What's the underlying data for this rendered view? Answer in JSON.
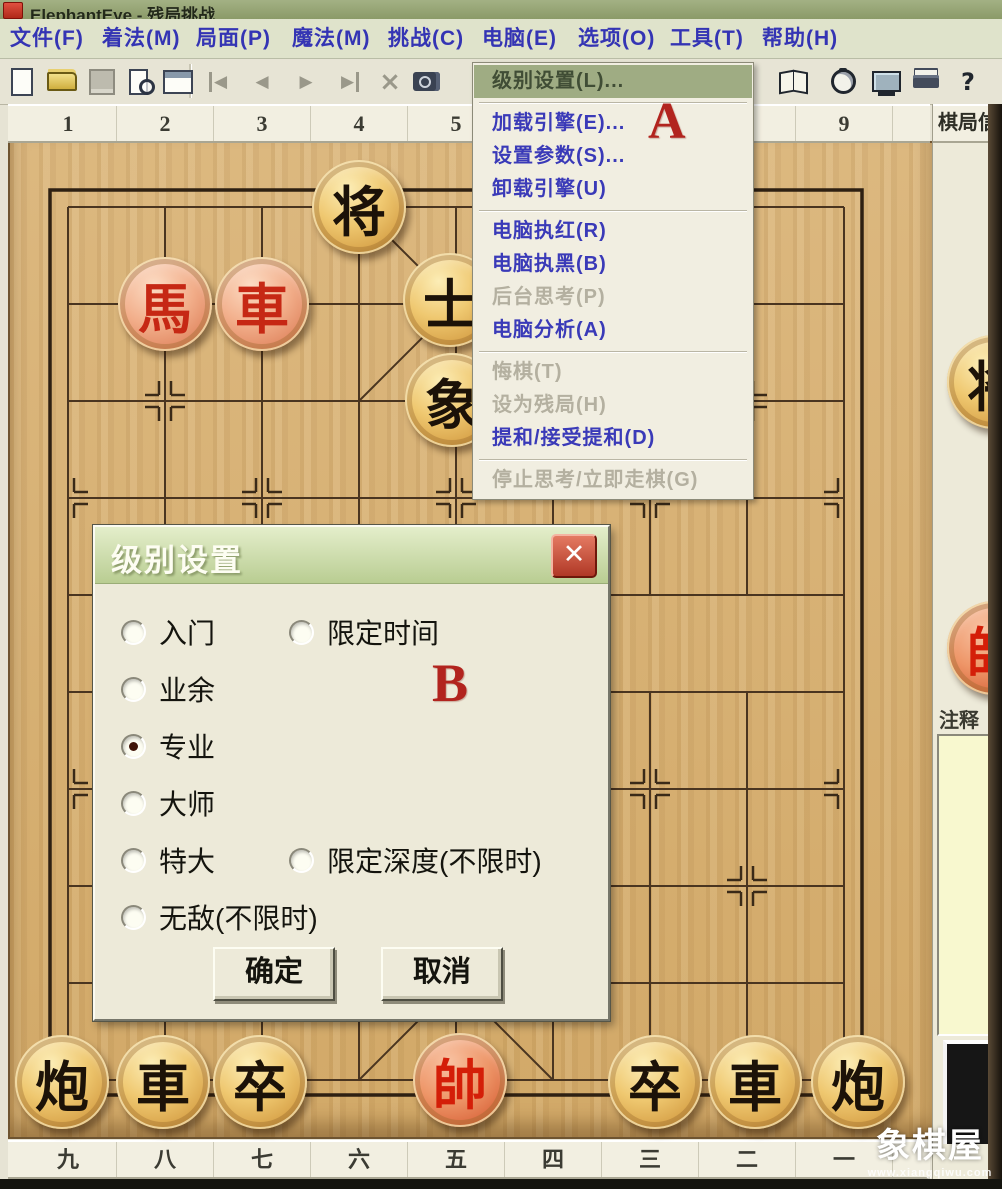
{
  "window": {
    "title": "ElephantEye - 残局挑战"
  },
  "menu_bar": {
    "items": [
      {
        "label": "文件(F)"
      },
      {
        "label": "着法(M)"
      },
      {
        "label": "局面(P)"
      },
      {
        "label": "魔法(M)"
      },
      {
        "label": "挑战(C)"
      },
      {
        "label": "电脑(E)",
        "open": true
      },
      {
        "label": "选项(O)"
      },
      {
        "label": "工具(T)"
      },
      {
        "label": "帮助(H)"
      }
    ]
  },
  "toolbar": {
    "icons": [
      {
        "name": "new-document-icon"
      },
      {
        "name": "open-file-icon"
      },
      {
        "name": "save-icon"
      },
      {
        "name": "print-preview-icon"
      },
      {
        "name": "board-properties-icon"
      },
      {
        "name": "first-move-icon",
        "glyph": "◀"
      },
      {
        "name": "previous-move-icon",
        "glyph": "◀"
      },
      {
        "name": "next-move-icon",
        "glyph": "▶"
      },
      {
        "name": "last-move-icon",
        "glyph": "▶"
      },
      {
        "name": "delete-move-icon",
        "glyph": "×"
      },
      {
        "name": "snapshot-icon"
      },
      {
        "name": "opening-book-icon"
      },
      {
        "name": "timer-icon"
      },
      {
        "name": "engine-icon"
      },
      {
        "name": "print-icon"
      },
      {
        "name": "help-icon",
        "glyph": "?"
      }
    ]
  },
  "computer_menu": {
    "items": [
      {
        "label": "级别设置(L)...",
        "state": "highlighted"
      },
      {
        "type": "separator"
      },
      {
        "label": "加载引擎(E)...",
        "state": "normal"
      },
      {
        "label": "设置参数(S)...",
        "state": "normal"
      },
      {
        "label": "卸载引擎(U)",
        "state": "normal"
      },
      {
        "type": "separator"
      },
      {
        "label": "电脑执红(R)",
        "state": "normal"
      },
      {
        "label": "电脑执黑(B)",
        "state": "normal"
      },
      {
        "label": "后台思考(P)",
        "state": "disabled"
      },
      {
        "label": "电脑分析(A)",
        "state": "normal"
      },
      {
        "type": "separator"
      },
      {
        "label": "悔棋(T)",
        "state": "disabled"
      },
      {
        "label": "设为残局(H)",
        "state": "disabled"
      },
      {
        "label": "提和/接受提和(D)",
        "state": "normal"
      },
      {
        "type": "separator"
      },
      {
        "label": "停止思考/立即走棋(G)",
        "state": "disabled"
      }
    ]
  },
  "annotations": {
    "label_a": "A",
    "label_b": "B"
  },
  "level_dialog": {
    "title": "级别设置",
    "close_glyph": "✕",
    "options_left": [
      {
        "label": "入门",
        "selected": false
      },
      {
        "label": "业余",
        "selected": false
      },
      {
        "label": "专业",
        "selected": true
      },
      {
        "label": "大师",
        "selected": false
      },
      {
        "label": "特大",
        "selected": false
      },
      {
        "label": "无敌(不限时)",
        "selected": false
      }
    ],
    "options_right": [
      {
        "label": "限定时间",
        "selected": false,
        "row": 0
      },
      {
        "label": "限定深度(不限时)",
        "selected": false,
        "row": 4
      }
    ],
    "ok_label": "确定",
    "cancel_label": "取消"
  },
  "board": {
    "top_labels": [
      "1",
      "2",
      "3",
      "4",
      "5",
      "6",
      "7",
      "8",
      "9"
    ],
    "bottom_labels": [
      "九",
      "八",
      "七",
      "六",
      "五",
      "四",
      "三",
      "二",
      "一"
    ],
    "pieces": [
      {
        "char": "将",
        "color": "black",
        "x": 359,
        "y": 207
      },
      {
        "char": "馬",
        "color": "red",
        "x": 165,
        "y": 304
      },
      {
        "char": "車",
        "color": "red",
        "x": 262,
        "y": 304
      },
      {
        "char": "士",
        "color": "black",
        "x": 450,
        "y": 300
      },
      {
        "char": "象",
        "color": "black",
        "x": 452,
        "y": 400
      },
      {
        "char": "炮",
        "color": "black",
        "x": 62,
        "y": 1082
      },
      {
        "char": "車",
        "color": "black",
        "x": 163,
        "y": 1082
      },
      {
        "char": "卒",
        "color": "black",
        "x": 260,
        "y": 1082
      },
      {
        "char": "帥",
        "color": "red",
        "deep": true,
        "x": 460,
        "y": 1080
      },
      {
        "char": "卒",
        "color": "black",
        "x": 655,
        "y": 1082
      },
      {
        "char": "車",
        "color": "black",
        "x": 755,
        "y": 1082
      },
      {
        "char": "炮",
        "color": "black",
        "x": 858,
        "y": 1082
      }
    ]
  },
  "side_panel": {
    "header": "棋局信息",
    "comment_label": "注释",
    "pieces": [
      {
        "char": "将",
        "color": "black",
        "x": 994,
        "y": 382
      },
      {
        "char": "帥",
        "color": "red",
        "deep": true,
        "x": 994,
        "y": 648
      }
    ]
  },
  "watermark": {
    "title": "象棋屋",
    "url": "www.xiangqiwu.com"
  }
}
